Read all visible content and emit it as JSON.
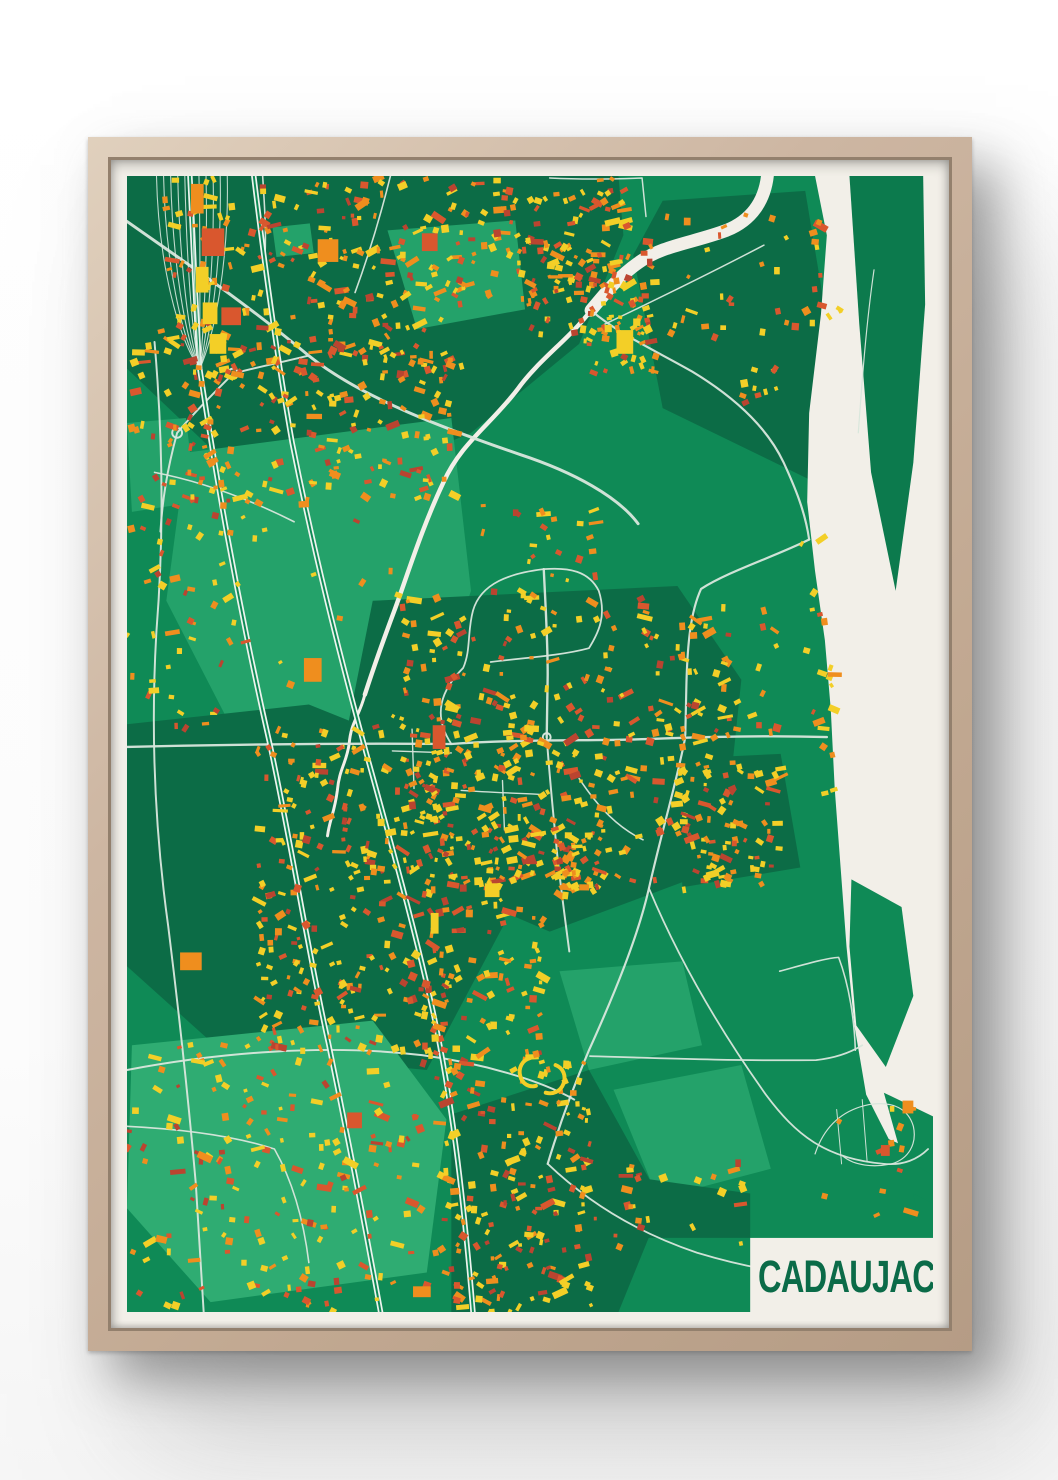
{
  "poster": {
    "title": "CADAUJAC"
  },
  "palette": {
    "base": "#0F8A56",
    "dark": "#0C6C46",
    "light": "#24A26A",
    "lighter": "#2FAC72",
    "island": "#0C7A4D",
    "river": "#F2EFE8",
    "mat": "#F2EFE8",
    "road": "#D7E6DC",
    "rail": "#EDF4EE",
    "railgap": "#0F8A56",
    "fan": "#DFEDE4",
    "title": "#0B6B48",
    "frame_wood": "#C9B29E",
    "buildings": {
      "y": "#F3CF27",
      "o": "#EF8E1E",
      "r": "#D9572E",
      "d": "#BA4430"
    }
  },
  "map": {
    "width": 820,
    "height": 1150,
    "areas": [
      {
        "tone": "dark",
        "points": "0,0 500,0 505,60 460,170 350,260 230,310 90,280 0,195"
      },
      {
        "tone": "dark",
        "points": "515,80 545,25 690,15 715,165 700,310 545,235"
      },
      {
        "tone": "light",
        "points": "265,55 395,45 405,135 295,155"
      },
      {
        "tone": "light",
        "points": "148,52 186,48 190,78 152,82"
      },
      {
        "tone": "light",
        "points": "0,250 60,245 70,330 5,340"
      },
      {
        "tone": "light",
        "points": "60,280 330,245 350,420 300,565 115,575 40,430"
      },
      {
        "tone": "dark",
        "points": "250,430 560,415 625,510 605,700 430,765 255,690 225,555"
      },
      {
        "tone": "dark",
        "points": "0,555 185,535 335,595 385,755 305,905 95,885 0,800"
      },
      {
        "tone": "lighter",
        "points": "5,880 250,855 325,955 305,1110 85,1140 0,1045"
      },
      {
        "tone": "dark",
        "points": "330,950 470,905 545,1040 500,1150 330,1150"
      },
      {
        "tone": "light",
        "points": "440,805 565,795 585,880 470,905"
      },
      {
        "tone": "light",
        "points": "495,925 625,900 655,1005 540,1035"
      },
      {
        "tone": "dark",
        "points": "455,1005 634,1030 634,1075 465,1075"
      },
      {
        "tone": "dark",
        "points": "560,590 665,585 685,700 565,720"
      }
    ],
    "river": {
      "points": "700,0 712,60 706,140 694,240 692,330 700,400 710,470 716,540 720,620 726,700 732,780 740,860 752,930 775,975 820,995 820,0"
    },
    "streams": [
      {
        "d": "M652,-5 C650,25 635,45 610,55 C575,68 545,70 520,88 C500,102 487,118 472,136",
        "w": 13
      },
      {
        "d": "M472,136 C450,165 420,185 398,215 C370,252 340,270 322,310 C300,356 285,405 272,440 C260,472 250,500 242,525",
        "w": 4.5
      },
      {
        "d": "M242,525 C236,548 228,552 226,575 C223,595 216,600 214,622 C211,645 206,652 204,668",
        "w": 3
      }
    ],
    "islands": [
      {
        "tone": "island",
        "points": "735,0 810,0 812,130 800,290 782,420 757,300 745,150"
      },
      {
        "tone": "base",
        "points": "737,712 788,740 800,830 772,902 742,860 735,780"
      },
      {
        "tone": "base",
        "points": "770,928 820,952 820,1012 788,992"
      },
      {
        "tone": "base",
        "points": "800,1030 820,1040 820,1062 803,1048"
      }
    ],
    "roads": [
      {
        "d": "M0,46 C60,88 120,128 185,182 C240,226 330,258 400,282 C455,300 500,325 520,352",
        "w": 3
      },
      {
        "d": "M184,182 C160,188 130,194 108,200",
        "w": 2
      },
      {
        "d": "M108,200 C88,220 68,240 51,260 C40,300 36,330 34,360",
        "w": 2
      },
      {
        "d": "M472,136 C500,160 540,178 575,198 C615,222 650,252 668,290 C680,316 690,340 694,368",
        "w": 2.2
      },
      {
        "d": "M694,368 C660,385 612,400 584,418 C574,440 570,470 569,520 L568,566",
        "w": 2.2
      },
      {
        "d": "M0,578 C80,576 200,574 330,575 C400,570 470,572 530,570 C580,568 650,566 712,568",
        "w": 2.4
      },
      {
        "d": "M568,568 C560,610 545,660 531,721 C520,770 495,830 470,885 C455,920 440,960 428,1000",
        "w": 2.2
      },
      {
        "d": "M424,398 C426,440 428,470 428,505 L427,568",
        "w": 2.4
      },
      {
        "d": "M424,398 C390,402 360,412 352,440 C346,462 350,480 342,498 C320,520 310,545 330,575",
        "w": 1.8
      },
      {
        "d": "M424,398 C450,396 470,400 480,420 C488,445 480,462 470,478 C440,486 400,488 370,492",
        "w": 1.8
      },
      {
        "d": "M427,568 C430,610 434,650 438,690 C442,725 446,755 450,785",
        "w": 2
      },
      {
        "d": "M460,610 C480,640 500,660 525,672",
        "w": 1.6
      },
      {
        "d": "M340,622 C370,624 400,625 420,626",
        "w": 1.4
      },
      {
        "d": "M382,612 L384,662",
        "w": 1.4
      },
      {
        "d": "M290,560 L292,620",
        "w": 1.4
      },
      {
        "d": "M270,582 L330,584",
        "w": 1.4
      },
      {
        "d": "M28,168 C36,260 38,360 30,460 C24,560 28,660 42,760 C52,840 62,930 70,1020 C74,1080 76,1120 78,1150",
        "w": 2
      },
      {
        "d": "M28,300 C80,310 130,330 170,350",
        "w": 1.6
      },
      {
        "d": "M0,905 C90,888 200,878 300,890 C360,898 420,915 455,935",
        "w": 2
      },
      {
        "d": "M0,962 C60,965 110,972 150,985 C170,1020 180,1060 185,1100",
        "w": 1.6
      },
      {
        "d": "M138,0 C140,30 142,60 140,88",
        "w": 1.6
      },
      {
        "d": "M268,0 C258,40 246,80 232,118",
        "w": 1.6
      },
      {
        "d": "M430,2 C470,4 500,3 524,2 L528,41",
        "w": 1.5
      },
      {
        "d": "M648,70 C600,95 545,122 486,150",
        "w": 1.5
      },
      {
        "d": "M428,1000 C470,1040 520,1070 580,1090 C640,1108 690,1115 740,1112",
        "w": 1.8
      },
      {
        "d": "M531,721 C560,790 600,860 650,930 C680,970 710,995 770,1000 C790,1002 805,995 815,985",
        "w": 1.8
      },
      {
        "d": "M471,891 C540,893 620,896 701,895 C720,893 735,888 748,880",
        "w": 1.8
      },
      {
        "d": "M664,805 C690,798 710,792 724,791 C735,820 740,855 741,885",
        "w": 1.6
      },
      {
        "d": "M700,990 C710,960 730,945 755,940 C780,936 795,945 800,962 C804,980 795,995 778,1000 C760,1004 740,1002 728,992",
        "w": 1.2
      },
      {
        "d": "M722,945 L727,1000",
        "w": 1
      },
      {
        "d": "M748,935 L753,998",
        "w": 1
      },
      {
        "d": "M760,95 C752,150 748,205 744,260",
        "w": 1.2
      }
    ],
    "roundabouts": [
      {
        "cx": 108,
        "cy": 200,
        "r": 5
      },
      {
        "cx": 51,
        "cy": 260,
        "r": 5
      },
      {
        "cx": 427,
        "cy": 568,
        "r": 4
      }
    ],
    "railways": [
      {
        "d": "M64,0 C68,80 70,140 74,195 C90,300 110,420 146,578 C170,690 185,790 205,878 C222,960 238,1040 258,1150"
      },
      {
        "d": "M129,0 C140,90 152,180 168,270 C190,380 215,480 245,590 C270,680 292,760 310,840 C330,930 342,1030 352,1150"
      }
    ],
    "fan": {
      "x0": 30,
      "x1": 102,
      "n": 11,
      "cx": 74,
      "cy": 195
    },
    "clusters": [
      {
        "x": 30,
        "y": 0,
        "w": 300,
        "h": 200,
        "n": 230
      },
      {
        "x": 330,
        "y": 0,
        "w": 180,
        "h": 130,
        "n": 120
      },
      {
        "x": 0,
        "y": 150,
        "w": 95,
        "h": 190,
        "n": 55
      },
      {
        "x": 60,
        "y": 165,
        "w": 280,
        "h": 165,
        "n": 170
      },
      {
        "x": 0,
        "y": 345,
        "w": 120,
        "h": 215,
        "n": 45
      },
      {
        "x": 405,
        "y": 62,
        "w": 135,
        "h": 100,
        "n": 75
      },
      {
        "x": 462,
        "y": 140,
        "w": 75,
        "h": 60,
        "n": 30
      },
      {
        "x": 275,
        "y": 425,
        "w": 340,
        "h": 290,
        "n": 340
      },
      {
        "x": 560,
        "y": 590,
        "w": 105,
        "h": 130,
        "n": 70
      },
      {
        "x": 428,
        "y": 660,
        "w": 55,
        "h": 65,
        "n": 48
      },
      {
        "x": 128,
        "y": 555,
        "w": 205,
        "h": 330,
        "n": 280
      },
      {
        "x": 300,
        "y": 560,
        "w": 125,
        "h": 340,
        "n": 150
      },
      {
        "x": 0,
        "y": 875,
        "w": 330,
        "h": 270,
        "n": 190
      },
      {
        "x": 320,
        "y": 895,
        "w": 150,
        "h": 255,
        "n": 170
      },
      {
        "x": 686,
        "y": 355,
        "w": 30,
        "h": 270,
        "n": 20
      },
      {
        "x": 690,
        "y": 925,
        "w": 115,
        "h": 130,
        "n": 12,
        "mix": "golf"
      },
      {
        "x": 540,
        "y": 35,
        "w": 165,
        "h": 130,
        "n": 28
      },
      {
        "x": 615,
        "y": 190,
        "w": 55,
        "h": 45,
        "n": 10
      },
      {
        "x": 560,
        "y": 435,
        "w": 105,
        "h": 125,
        "n": 22
      },
      {
        "x": 465,
        "y": 995,
        "w": 160,
        "h": 85,
        "n": 26
      },
      {
        "x": 120,
        "y": 330,
        "w": 230,
        "h": 220,
        "n": 18
      },
      {
        "x": 690,
        "y": 40,
        "w": 40,
        "h": 120,
        "n": 10
      },
      {
        "x": 355,
        "y": 330,
        "w": 120,
        "h": 95,
        "n": 26
      }
    ],
    "landmarks": [
      {
        "x": 65,
        "y": 8,
        "w": 13,
        "h": 30,
        "c": "o"
      },
      {
        "x": 76,
        "y": 53,
        "w": 23,
        "h": 28,
        "c": "r"
      },
      {
        "x": 70,
        "y": 92,
        "w": 13,
        "h": 26,
        "c": "y"
      },
      {
        "x": 77,
        "y": 128,
        "w": 15,
        "h": 22,
        "c": "y"
      },
      {
        "x": 84,
        "y": 160,
        "w": 17,
        "h": 20,
        "c": "y"
      },
      {
        "x": 96,
        "y": 133,
        "w": 20,
        "h": 18,
        "c": "r"
      },
      {
        "x": 194,
        "y": 64,
        "w": 21,
        "h": 23,
        "c": "o"
      },
      {
        "x": 300,
        "y": 58,
        "w": 16,
        "h": 18,
        "c": "r"
      },
      {
        "x": 498,
        "y": 156,
        "w": 17,
        "h": 24,
        "c": "y"
      },
      {
        "x": 54,
        "y": 786,
        "w": 22,
        "h": 18,
        "c": "o"
      },
      {
        "x": 311,
        "y": 556,
        "w": 13,
        "h": 24,
        "c": "r"
      },
      {
        "x": 180,
        "y": 488,
        "w": 18,
        "h": 24,
        "c": "o"
      },
      {
        "x": 224,
        "y": 948,
        "w": 15,
        "h": 16,
        "c": "r"
      },
      {
        "x": 291,
        "y": 1124,
        "w": 18,
        "h": 11,
        "c": "o"
      },
      {
        "x": 364,
        "y": 716,
        "w": 15,
        "h": 14,
        "c": "y"
      },
      {
        "x": 309,
        "y": 746,
        "w": 8,
        "h": 21,
        "c": "y"
      },
      {
        "x": 789,
        "y": 936,
        "w": 11,
        "h": 13,
        "c": "o"
      },
      {
        "x": 767,
        "y": 981,
        "w": 9,
        "h": 11,
        "c": "r"
      }
    ],
    "stadium": [
      {
        "d": "M410,893 c-8,2 -12,10 -10,18 c2,8 9,12 16,10",
        "w": 4
      },
      {
        "d": "M436,900 c8,3 11,11 8,19 c-3,8 -11,11 -18,9",
        "w": 4
      }
    ],
    "title_block": {
      "x": 634,
      "y": 1075,
      "w": 186,
      "h": 75
    }
  }
}
